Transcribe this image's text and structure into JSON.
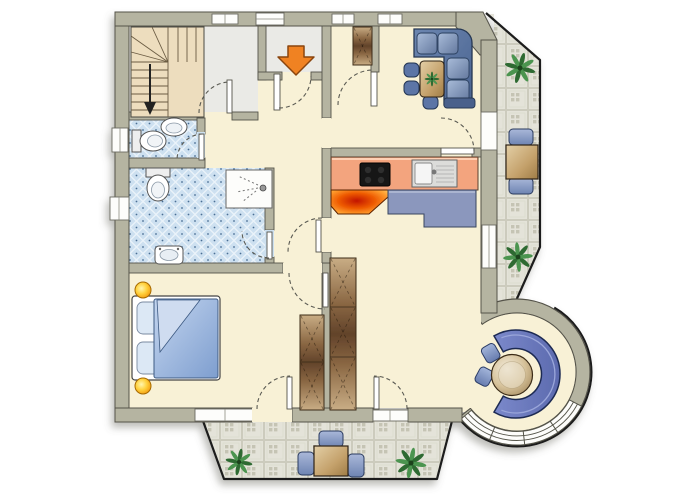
{
  "meta": {
    "type": "floor-plan",
    "description": "Furnished apartment floor plan with entrance staircase, two bathrooms, bedroom, kitchen, living-dining room, round bay seating nook and two tiled terraces",
    "canvas": {
      "width": 700,
      "height": 500
    }
  },
  "palette": {
    "outline": "#1c1c1c",
    "wall_fill": "#b5b4a1",
    "wall_edge": "#54534a",
    "floor_cream": "#f8f1d6",
    "floor_hall_grey": "#eaeae6",
    "tile_bath_blue": "#cde0f0",
    "tile_terrace": "#e4e3d9",
    "counter_salmon": "#f3a47e",
    "stove_black": "#151515",
    "fire_orange": "#ee5a00",
    "cabinet_blue": "#8b97bd",
    "sofa_blue": "#5d77a4",
    "bench_blue": "#6d7cbd",
    "chair_blue": "#7186b4",
    "wood_brown": "#8a6743",
    "table_tan": "#c9ad82",
    "lamp_yellow": "#ffd23e",
    "arrow_orange": "#f08220",
    "plant_green": "#2f6f33",
    "window_white": "#fdfdfb"
  },
  "rooms": [
    {
      "id": "stair-hall",
      "label": "Entrance hall with staircase",
      "floor": "grey"
    },
    {
      "id": "vestibule",
      "label": "Entry vestibule",
      "floor": "grey"
    },
    {
      "id": "wc",
      "label": "Guest WC",
      "floor": "blue tile"
    },
    {
      "id": "bathroom",
      "label": "Bathroom with shower",
      "floor": "blue tile"
    },
    {
      "id": "corridor",
      "label": "Corridor",
      "floor": "cream"
    },
    {
      "id": "bedroom",
      "label": "Bedroom",
      "floor": "cream"
    },
    {
      "id": "kitchen",
      "label": "Kitchen",
      "floor": "cream"
    },
    {
      "id": "living-dining",
      "label": "Living / dining room",
      "floor": "cream"
    },
    {
      "id": "round-bay",
      "label": "Round bay seating nook",
      "floor": "cream"
    },
    {
      "id": "side-terrace",
      "label": "Side terrace",
      "floor": "tile"
    },
    {
      "id": "lower-terrace",
      "label": "Lower terrace",
      "floor": "tile"
    }
  ],
  "furniture": [
    {
      "id": "staircase",
      "label": "Winder staircase going down"
    },
    {
      "id": "entry-closet",
      "label": "Hall closet"
    },
    {
      "id": "wc-toilet",
      "label": "WC toilet"
    },
    {
      "id": "wc-washbasin",
      "label": "WC washbasin"
    },
    {
      "id": "bath-toilet",
      "label": "Bathroom toilet"
    },
    {
      "id": "shower",
      "label": "Shower"
    },
    {
      "id": "bath-washbasin",
      "label": "Bathroom washbasin"
    },
    {
      "id": "double-bed",
      "label": "Double bed with pillows and blue duvet"
    },
    {
      "id": "bedside-lamps",
      "label": "Two yellow bedside lamps"
    },
    {
      "id": "bedroom-wardrobe",
      "label": "Bedroom wardrobe"
    },
    {
      "id": "hall-wardrobe",
      "label": "Corridor wardrobe"
    },
    {
      "id": "corner-sofa",
      "label": "Blue corner sofa"
    },
    {
      "id": "coffee-table",
      "label": "Coffee table with plant"
    },
    {
      "id": "dining-chairs",
      "label": "Three blue chairs"
    },
    {
      "id": "kitchen-counter",
      "label": "Kitchen counter"
    },
    {
      "id": "cooktop",
      "label": "Black cooktop"
    },
    {
      "id": "kitchen-sink",
      "label": "Kitchen sink with drainer"
    },
    {
      "id": "tiled-stove",
      "label": "Glowing stove / fireplace"
    },
    {
      "id": "sideboard",
      "label": "Blue sideboard"
    },
    {
      "id": "bay-bench",
      "label": "Curved blue bay bench"
    },
    {
      "id": "bay-table",
      "label": "Round bay table"
    },
    {
      "id": "bay-stools",
      "label": "Two blue stools"
    },
    {
      "id": "side-terrace-table",
      "label": "Side terrace table"
    },
    {
      "id": "side-terrace-chairs",
      "label": "Two side terrace chairs"
    },
    {
      "id": "lower-terrace-table",
      "label": "Lower terrace table"
    },
    {
      "id": "lower-terrace-chairs",
      "label": "Three lower terrace chairs"
    },
    {
      "id": "potted-plants",
      "label": "Potted plants"
    },
    {
      "id": "entrance-arrow",
      "label": "Orange entrance direction arrow"
    },
    {
      "id": "stair-arrow",
      "label": "Stair direction arrow"
    }
  ],
  "openings": {
    "door_swings": 10,
    "windows": 7,
    "round_bay_window_segments": 3
  }
}
